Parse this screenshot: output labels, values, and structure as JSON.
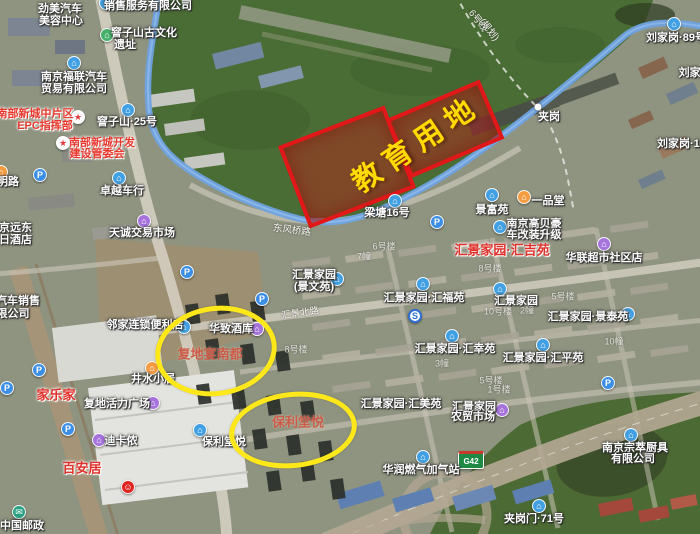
{
  "annotations": {
    "education_zone": {
      "label": "教育用地"
    },
    "ellipses": [
      {
        "label": "复地宴南都"
      },
      {
        "label": "保利堂悦"
      }
    ],
    "colors": {
      "zone_border": "#e21717",
      "zone_fill": "rgba(200,25,25,0.42)",
      "zone_text": "#ffdb00",
      "ellipse_stroke": "#ffe81a",
      "highlight_poi_red": "#e0302a",
      "annotation_text": "#cc5a49",
      "river_blue": "#6fa3e2"
    },
    "road_shield": {
      "text": "G42"
    }
  },
  "map": {
    "labels": [
      {
        "s": "销售服务有限公司",
        "x": 148,
        "y": 5,
        "c": "w"
      },
      {
        "s": "劲美汽车",
        "x": 60,
        "y": 8,
        "c": "w"
      },
      {
        "s": "美容中心",
        "x": 61,
        "y": 20,
        "c": "w"
      },
      {
        "s": "窨子山古文化",
        "x": 144,
        "y": 32,
        "c": "w"
      },
      {
        "s": "遗址",
        "x": 125,
        "y": 44,
        "c": "w"
      },
      {
        "s": "刘家岗·89号",
        "x": 676,
        "y": 37,
        "c": "w"
      },
      {
        "s": "刘家岗·",
        "x": 697,
        "y": 72,
        "c": "w"
      },
      {
        "s": "刘家岗·124号",
        "x": 690,
        "y": 143,
        "c": "w"
      },
      {
        "s": "南京福联汽车",
        "x": 74,
        "y": 76,
        "c": "w"
      },
      {
        "s": "贸易有限公司",
        "x": 74,
        "y": 88,
        "c": "w"
      },
      {
        "s": "南部新城中片区",
        "x": 35,
        "y": 113,
        "c": "r"
      },
      {
        "s": "EPC指挥部",
        "x": 45,
        "y": 125,
        "c": "r"
      },
      {
        "s": "窨子山·25号",
        "x": 127,
        "y": 121,
        "c": "w"
      },
      {
        "s": "南部新城开发",
        "x": 102,
        "y": 142,
        "c": "r"
      },
      {
        "s": "建设管委会",
        "x": 97,
        "y": 153,
        "c": "r"
      },
      {
        "s": "6号线",
        "x": 479,
        "y": 20,
        "c": "rd",
        "r": 52
      },
      {
        "s": "(规划)",
        "x": 490,
        "y": 29,
        "c": "rd",
        "r": 52
      },
      {
        "s": "夹岗",
        "x": 549,
        "y": 116,
        "c": "w"
      },
      {
        "s": "明路",
        "x": 8,
        "y": 181,
        "c": "w"
      },
      {
        "s": "卓越车行",
        "x": 122,
        "y": 190,
        "c": "w"
      },
      {
        "s": "东风桥路",
        "x": 292,
        "y": 229,
        "c": "rd",
        "r": 7
      },
      {
        "s": "梁塘16号",
        "x": 387,
        "y": 212,
        "c": "w"
      },
      {
        "s": "景富苑",
        "x": 492,
        "y": 209,
        "c": "w"
      },
      {
        "s": "一品堂",
        "x": 548,
        "y": 200,
        "c": "w"
      },
      {
        "s": "南京远东",
        "x": 10,
        "y": 227,
        "c": "w"
      },
      {
        "s": "假日酒店",
        "x": 10,
        "y": 239,
        "c": "w"
      },
      {
        "s": "天诚交易市场",
        "x": 142,
        "y": 232,
        "c": "w"
      },
      {
        "s": "南京高贝豪",
        "x": 534,
        "y": 223,
        "c": "w"
      },
      {
        "s": "车改装升级",
        "x": 534,
        "y": 234,
        "c": "w"
      },
      {
        "s": "汇景家园·汇吉苑",
        "x": 502,
        "y": 249,
        "c": "R",
        "n": "highlight-label-huijiyuan"
      },
      {
        "s": "华联超市社区店",
        "x": 604,
        "y": 257,
        "c": "w"
      },
      {
        "s": "汇景家园",
        "x": 314,
        "y": 274,
        "c": "w"
      },
      {
        "s": "(景文苑)",
        "x": 314,
        "y": 286,
        "c": "w"
      },
      {
        "s": "汇景家园·汇福苑",
        "x": 424,
        "y": 297,
        "c": "w"
      },
      {
        "s": "汇景家园",
        "x": 516,
        "y": 300,
        "c": "w"
      },
      {
        "s": "汽车销售",
        "x": 18,
        "y": 300,
        "c": "w"
      },
      {
        "s": "限公司",
        "x": 13,
        "y": 313,
        "c": "w"
      },
      {
        "s": "汇景家园·景泰苑",
        "x": 588,
        "y": 316,
        "c": "w"
      },
      {
        "s": "邻家连锁便利店",
        "x": 145,
        "y": 324,
        "c": "w"
      },
      {
        "s": "华致酒库",
        "x": 231,
        "y": 328,
        "c": "w"
      },
      {
        "s": "汇景北路",
        "x": 300,
        "y": 312,
        "c": "rd",
        "r": -8
      },
      {
        "s": "汇景家园·汇幸苑",
        "x": 455,
        "y": 348,
        "c": "w"
      },
      {
        "s": "汇景家园·汇平苑",
        "x": 543,
        "y": 357,
        "c": "w"
      },
      {
        "s": "井水小居",
        "x": 153,
        "y": 378,
        "c": "w"
      },
      {
        "s": "家乐家",
        "x": 56,
        "y": 394,
        "c": "R",
        "n": "highlight-label-jialejia"
      },
      {
        "s": "复地活力广场",
        "x": 117,
        "y": 403,
        "c": "w"
      },
      {
        "s": "汇景家园·汇美苑",
        "x": 401,
        "y": 403,
        "c": "w"
      },
      {
        "s": "汇景家园",
        "x": 474,
        "y": 406,
        "c": "w"
      },
      {
        "s": "农贸市场",
        "x": 473,
        "y": 416,
        "c": "w"
      },
      {
        "s": "保利堂悦",
        "x": 224,
        "y": 441,
        "c": "w"
      },
      {
        "s": "迪卡侬",
        "x": 121,
        "y": 440,
        "c": "w"
      },
      {
        "s": "南京宗萃厨具",
        "x": 635,
        "y": 447,
        "c": "w"
      },
      {
        "s": "有限公司",
        "x": 633,
        "y": 458,
        "c": "w"
      },
      {
        "s": "百安居",
        "x": 82,
        "y": 467,
        "c": "R",
        "n": "highlight-label-baianju"
      },
      {
        "s": "华润燃气加气站",
        "x": 421,
        "y": 469,
        "c": "w"
      },
      {
        "s": "夹岗门·71号",
        "x": 534,
        "y": 518,
        "c": "w"
      },
      {
        "s": "中国邮政",
        "x": 22,
        "y": 525,
        "c": "w"
      },
      {
        "s": "6号楼",
        "x": 384,
        "y": 246,
        "c": "f"
      },
      {
        "s": "7幢",
        "x": 364,
        "y": 256,
        "c": "f"
      },
      {
        "s": "8号楼",
        "x": 490,
        "y": 268,
        "c": "f"
      },
      {
        "s": "5号楼",
        "x": 563,
        "y": 296,
        "c": "f"
      },
      {
        "s": "10号楼",
        "x": 498,
        "y": 311,
        "c": "f"
      },
      {
        "s": "2幢",
        "x": 527,
        "y": 310,
        "c": "f"
      },
      {
        "s": "10幢",
        "x": 614,
        "y": 341,
        "c": "f"
      },
      {
        "s": "8号楼",
        "x": 296,
        "y": 349,
        "c": "f"
      },
      {
        "s": "3幢",
        "x": 442,
        "y": 363,
        "c": "f"
      },
      {
        "s": "5号楼",
        "x": 491,
        "y": 380,
        "c": "f"
      },
      {
        "s": "1号楼",
        "x": 499,
        "y": 389,
        "c": "f"
      }
    ],
    "icons": [
      {
        "n": "company-icon",
        "g": "⌂",
        "x": 106,
        "y": 3,
        "bg": "#41a0e3"
      },
      {
        "n": "heritage-icon",
        "g": "⌂",
        "x": 107,
        "y": 35,
        "bg": "#44b06a"
      },
      {
        "n": "poi-icon",
        "g": "⌂",
        "x": 674,
        "y": 24,
        "bg": "#41a0e3"
      },
      {
        "n": "car-dealer-icon",
        "g": "⌂",
        "x": 74,
        "y": 63,
        "bg": "#41a0e3"
      },
      {
        "n": "government-star-icon",
        "g": "★",
        "x": 78,
        "y": 117,
        "bg": "#ffffff",
        "fg": "#e23c3c"
      },
      {
        "n": "poi-icon",
        "g": "⌂",
        "x": 128,
        "y": 110,
        "bg": "#41a0e3"
      },
      {
        "n": "government-star-icon",
        "g": "★",
        "x": 63,
        "y": 143,
        "bg": "#ffffff",
        "fg": "#e23c3c"
      },
      {
        "n": "village-dot",
        "g": "",
        "x": 538,
        "y": 107,
        "bg": "#ffffff",
        "dot": true
      },
      {
        "n": "restaurant-icon",
        "g": "⌂",
        "x": 1,
        "y": 172,
        "bg": "#f59b40"
      },
      {
        "n": "parking-icon",
        "g": "P",
        "x": 40,
        "y": 175,
        "bg": "#3a8ee6"
      },
      {
        "n": "car-dealer-icon",
        "g": "⌂",
        "x": 119,
        "y": 178,
        "bg": "#41a0e3"
      },
      {
        "n": "residence-icon",
        "g": "⌂",
        "x": 395,
        "y": 201,
        "bg": "#41a0e3"
      },
      {
        "n": "residence-icon",
        "g": "⌂",
        "x": 492,
        "y": 195,
        "bg": "#41a0e3"
      },
      {
        "n": "restaurant-icon",
        "g": "⌂",
        "x": 524,
        "y": 197,
        "bg": "#f59b40"
      },
      {
        "n": "shopping-icon",
        "g": "⌂",
        "x": 144,
        "y": 221,
        "bg": "#a673dc"
      },
      {
        "n": "parking-icon",
        "g": "P",
        "x": 437,
        "y": 222,
        "bg": "#3a8ee6"
      },
      {
        "n": "car-dealer-icon",
        "g": "⌂",
        "x": 500,
        "y": 227,
        "bg": "#41a0e3"
      },
      {
        "n": "supermarket-icon",
        "g": "⌂",
        "x": 604,
        "y": 244,
        "bg": "#a673dc"
      },
      {
        "n": "parking-icon",
        "g": "P",
        "x": 187,
        "y": 272,
        "bg": "#3a8ee6"
      },
      {
        "n": "residence-icon",
        "g": "⌂",
        "x": 337,
        "y": 279,
        "bg": "#41a0e3"
      },
      {
        "n": "residence-icon",
        "g": "⌂",
        "x": 423,
        "y": 284,
        "bg": "#41a0e3"
      },
      {
        "n": "residence-icon",
        "g": "⌂",
        "x": 500,
        "y": 289,
        "bg": "#41a0e3"
      },
      {
        "n": "parking-icon",
        "g": "P",
        "x": 262,
        "y": 299,
        "bg": "#3a8ee6"
      },
      {
        "n": "residence-icon",
        "g": "⌂",
        "x": 628,
        "y": 314,
        "bg": "#41a0e3"
      },
      {
        "n": "metro-station-icon",
        "g": "S",
        "x": 415,
        "y": 316,
        "bg": "#ffffff",
        "fg": "#2e6fd0",
        "bd": "#2e6fd0"
      },
      {
        "n": "convenience-store-icon",
        "g": "⌂",
        "x": 184,
        "y": 327,
        "bg": "#41a0e3"
      },
      {
        "n": "wine-store-icon",
        "g": "⌂",
        "x": 257,
        "y": 329,
        "bg": "#a673dc"
      },
      {
        "n": "residence-icon",
        "g": "⌂",
        "x": 452,
        "y": 336,
        "bg": "#41a0e3"
      },
      {
        "n": "residence-icon",
        "g": "⌂",
        "x": 543,
        "y": 345,
        "bg": "#41a0e3"
      },
      {
        "n": "restaurant-icon",
        "g": "⌂",
        "x": 152,
        "y": 368,
        "bg": "#f59b40"
      },
      {
        "n": "parking-icon",
        "g": "P",
        "x": 39,
        "y": 370,
        "bg": "#3a8ee6"
      },
      {
        "n": "parking-icon",
        "g": "P",
        "x": 7,
        "y": 388,
        "bg": "#3a8ee6"
      },
      {
        "n": "parking-icon",
        "g": "P",
        "x": 608,
        "y": 383,
        "bg": "#3a8ee6"
      },
      {
        "n": "shopping-icon",
        "g": "⌂",
        "x": 153,
        "y": 403,
        "bg": "#a673dc"
      },
      {
        "n": "market-icon",
        "g": "⌂",
        "x": 502,
        "y": 410,
        "bg": "#a673dc"
      },
      {
        "n": "parking-icon",
        "g": "P",
        "x": 68,
        "y": 429,
        "bg": "#3a8ee6"
      },
      {
        "n": "residence-icon",
        "g": "⌂",
        "x": 200,
        "y": 430,
        "bg": "#41a0e3"
      },
      {
        "n": "company-icon",
        "g": "⌂",
        "x": 631,
        "y": 435,
        "bg": "#41a0e3"
      },
      {
        "n": "shopping-icon",
        "g": "⌂",
        "x": 99,
        "y": 440,
        "bg": "#a673dc"
      },
      {
        "n": "gas-station-icon",
        "g": "⌂",
        "x": 423,
        "y": 457,
        "bg": "#41a0e3"
      },
      {
        "n": "kfc-icon",
        "g": "☺",
        "x": 128,
        "y": 487,
        "bg": "#e0231d"
      },
      {
        "n": "poi-icon",
        "g": "⌂",
        "x": 539,
        "y": 506,
        "bg": "#41a0e3"
      },
      {
        "n": "post-office-icon",
        "g": "✉",
        "x": 19,
        "y": 512,
        "bg": "#29a083"
      }
    ]
  }
}
